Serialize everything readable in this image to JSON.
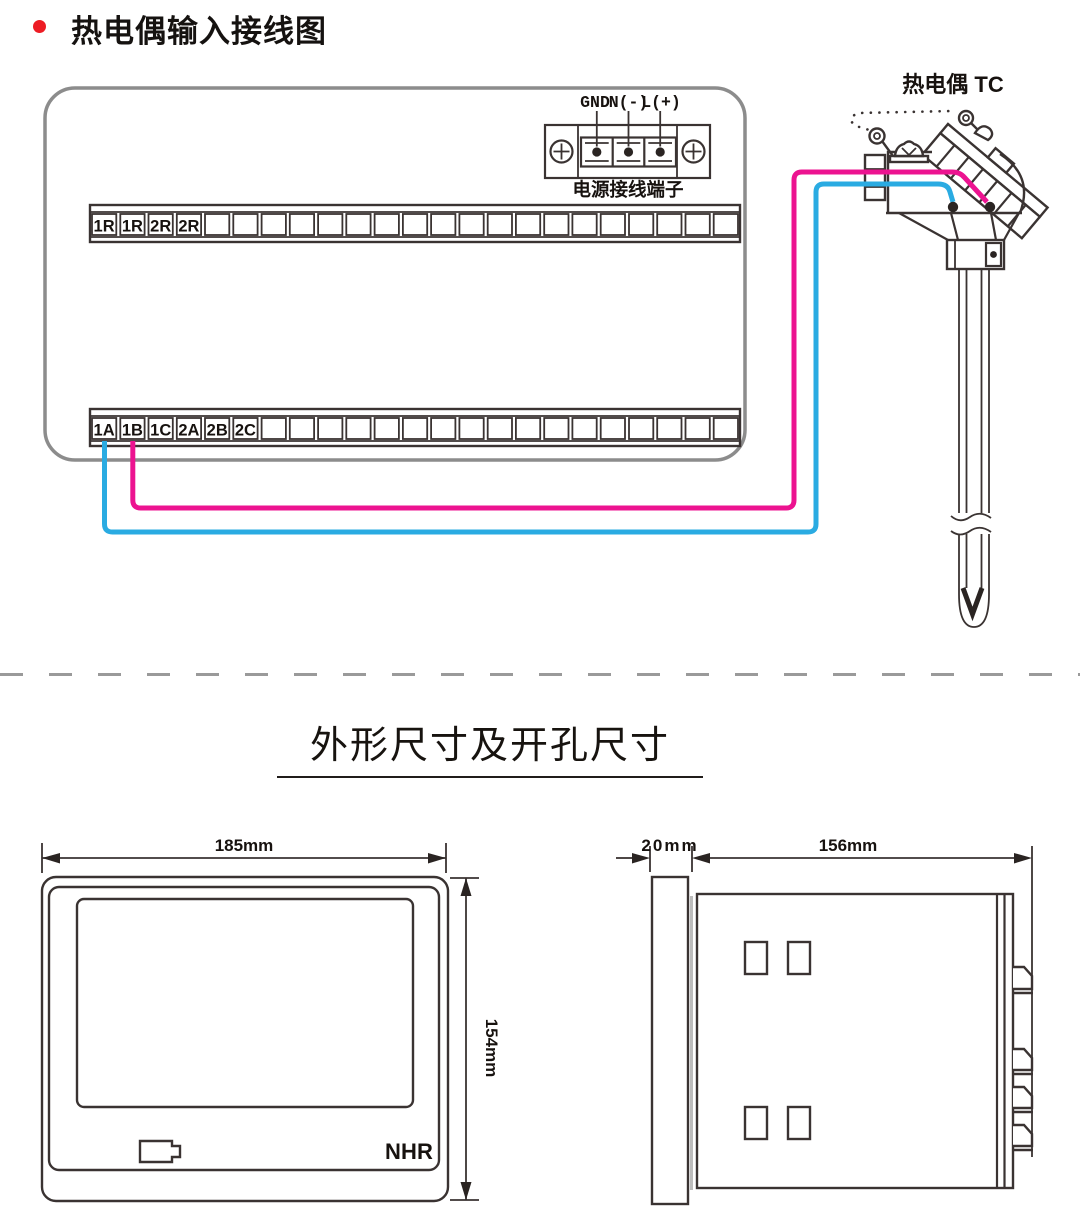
{
  "wiring": {
    "title": "热电偶输入接线图",
    "bullet_color": "#ed1c24",
    "thermocouple_label": "热电偶 TC",
    "power_terminal": {
      "labels": [
        "GND",
        "N(-)",
        "L(+)"
      ],
      "caption": "电源接线端子"
    },
    "top_strip": {
      "cells": 23,
      "labels": [
        "1R",
        "1R",
        "2R",
        "2R"
      ]
    },
    "bottom_strip": {
      "cells": 23,
      "labels": [
        "1A",
        "1B",
        "1C",
        "2A",
        "2B",
        "2C"
      ]
    },
    "wires": {
      "positive_color": "#ec1390",
      "negative_color": "#2aabe2"
    }
  },
  "dims": {
    "title": "外形尺寸及开孔尺寸",
    "front": {
      "width": "185mm",
      "height": "154mm"
    },
    "side": {
      "depth": "20mm",
      "length": "156mm"
    },
    "logo": {
      "n": "N",
      "h": "H",
      "r": "R",
      "gray": "#b7babf",
      "red": "#d63c2f"
    }
  }
}
